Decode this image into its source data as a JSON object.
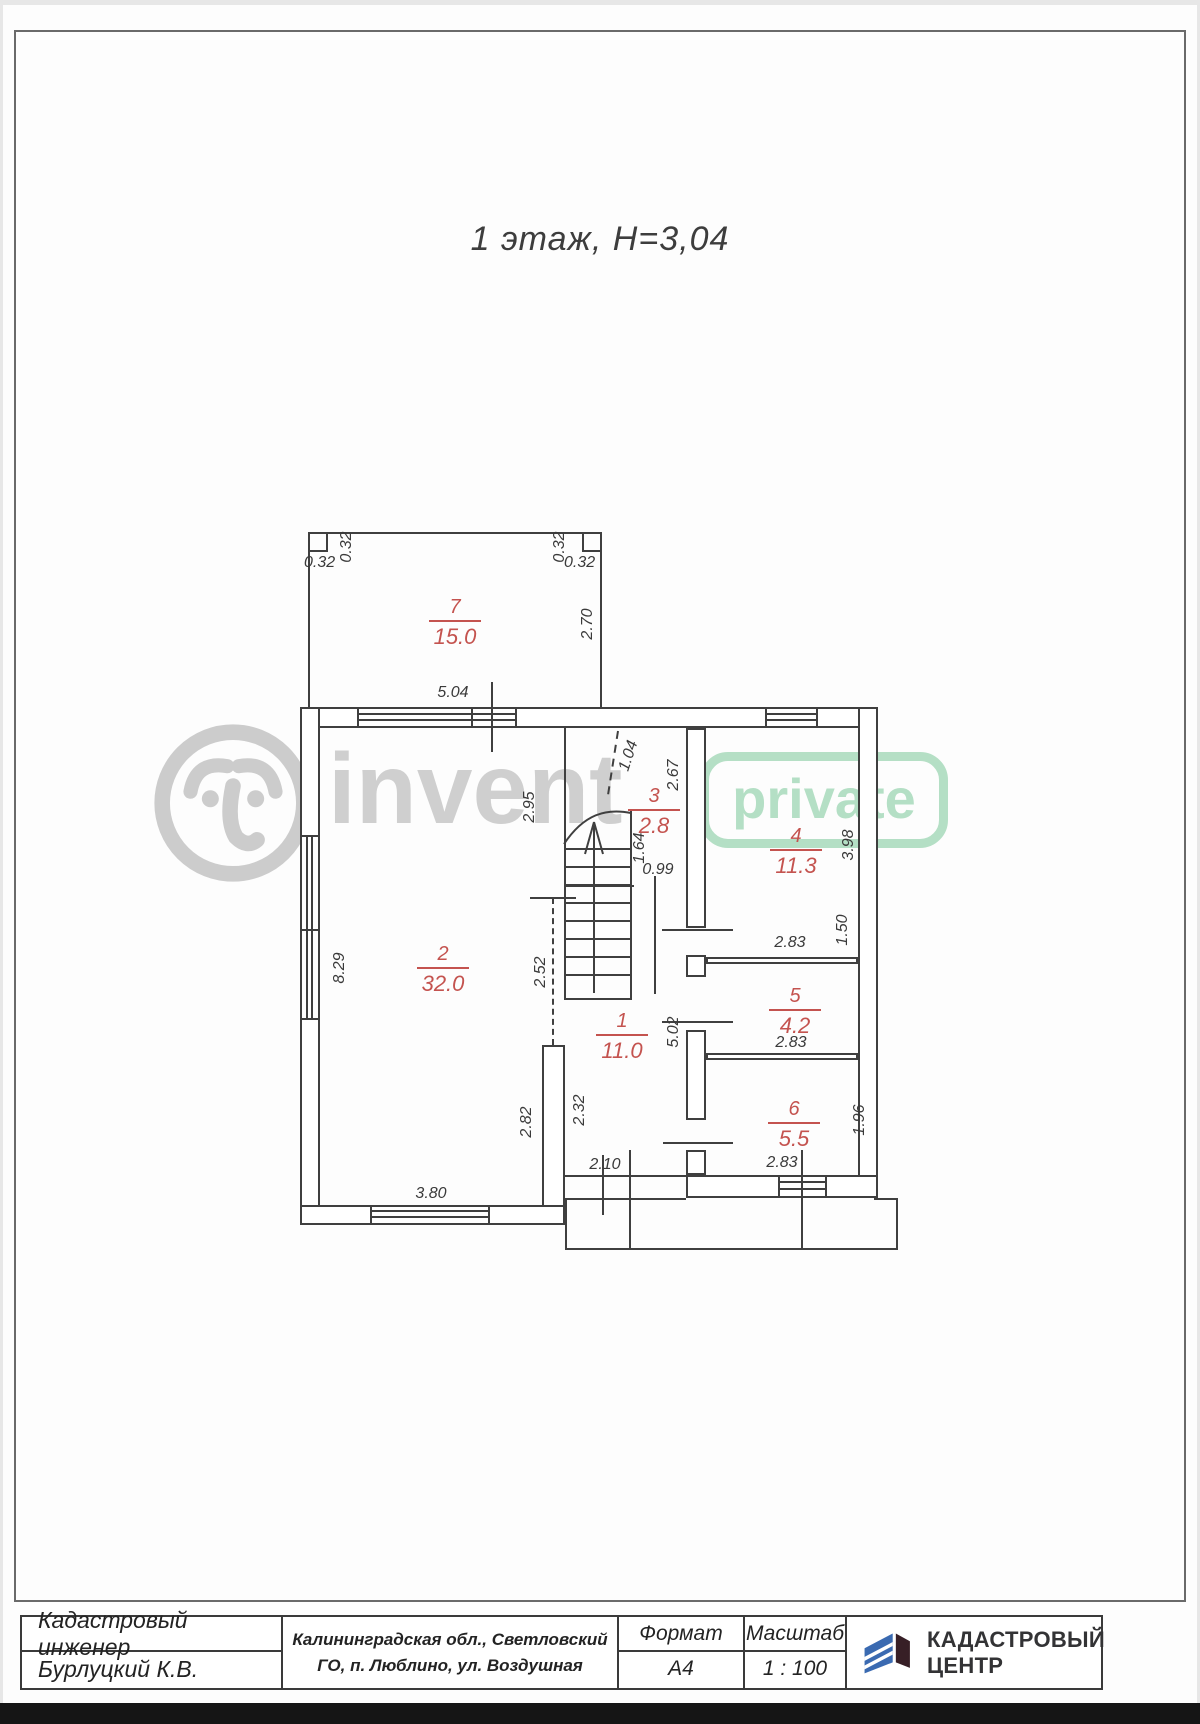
{
  "page": {
    "title": "1 этаж, Н=3,04"
  },
  "watermark": {
    "brand": "invent",
    "badge": "private",
    "gray": "#cbcbcb",
    "green": "#addcbf"
  },
  "plan": {
    "line_color": "#3f3f3f",
    "room_label_color": "#c4534f"
  },
  "rooms": {
    "r1": {
      "number": "1",
      "area": "11.0"
    },
    "r2": {
      "number": "2",
      "area": "32.0"
    },
    "r3": {
      "number": "3",
      "area": "2.8"
    },
    "r4": {
      "number": "4",
      "area": "11.3"
    },
    "r5": {
      "number": "5",
      "area": "4.2"
    },
    "r6": {
      "number": "6",
      "area": "5.5"
    },
    "r7": {
      "number": "7",
      "area": "15.0"
    }
  },
  "dims": {
    "notch_left_h": "0.32",
    "notch_left_v": "0.32",
    "notch_right_v": "0.32",
    "notch_right_h": "0.32",
    "room7_width": "5.04",
    "room7_depth": "2.70",
    "room2_upper_right": "2.95",
    "stair_hatch": "1.04",
    "stair_depth": "2.67",
    "stair_run": "1.64",
    "stair_door": "0.99",
    "room2_left": "8.29",
    "passage": "2.52",
    "room2_lower_right": "2.82",
    "hall_lower_left": "2.32",
    "room2_bottom": "3.80",
    "entry_opening": "2.10",
    "hall_length": "5.02",
    "room4_right": "3.98",
    "room4_bottom": "2.83",
    "room5_bottom": "2.83",
    "room6_bottom": "2.83",
    "room5_right": "1.50",
    "room6_right": "1.96"
  },
  "title_block": {
    "role": "Кадастровый инженер",
    "name": "Бурлуцкий К.В.",
    "address_line1": "Калининградская обл., Светловский",
    "address_line2": "ГО, п. Люблино, ул. Воздушная",
    "format_label": "Формат",
    "format_value": "А4",
    "scale_label": "Масштаб",
    "scale_value": "1 : 100",
    "logo_line1": "КАДАСТРОВЫЙ",
    "logo_line2": "ЦЕНТР",
    "logo_blue": "#3a6ab1",
    "logo_dark": "#371f26"
  }
}
